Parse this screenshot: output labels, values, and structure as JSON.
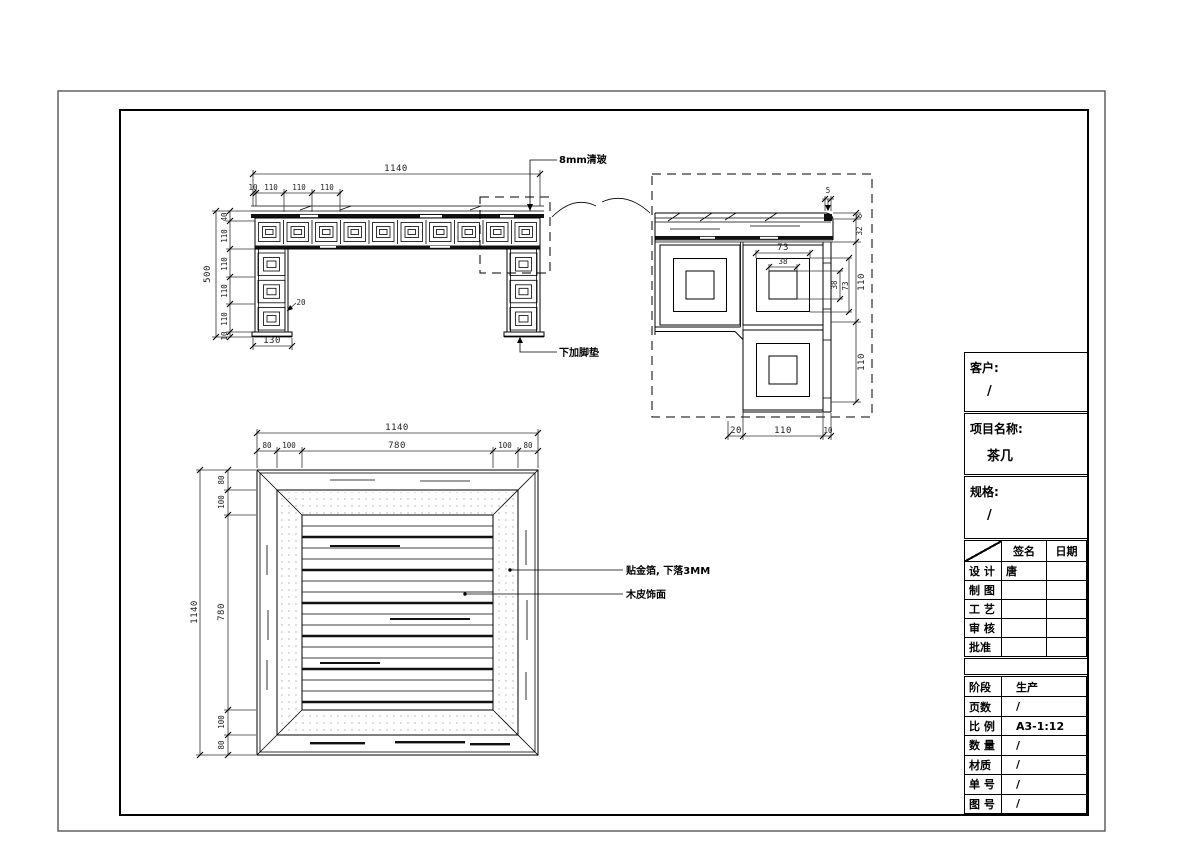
{
  "elevation": {
    "total_width": "1140",
    "top_segments": [
      "10",
      "110",
      "110",
      "110"
    ],
    "total_height": "500",
    "left_segments": [
      "40",
      "110",
      "110",
      "110",
      "110",
      "10"
    ],
    "leg_width": "130",
    "inset_dim": "20",
    "glass_label": "8mm清玻",
    "footpad_label": "下加脚垫"
  },
  "detail": {
    "overhang": "5",
    "right_segments": [
      "8",
      "32",
      "110",
      "110"
    ],
    "square_mid_width": "73",
    "square_inner_width": "38",
    "square_inner_height": "38",
    "square_mid_height": "73",
    "bottom_segments": [
      "20",
      "110",
      "10"
    ]
  },
  "plan": {
    "total_width": "1140",
    "top_segments": [
      "80",
      "100",
      "780",
      "100",
      "80"
    ],
    "total_height": "1140",
    "left_segments": [
      "80",
      "100",
      "780",
      "100",
      "80"
    ],
    "gold_label": "贴金箔, 下落3MM",
    "veneer_label": "木皮饰面"
  },
  "title_block": {
    "customer_label": "客户:",
    "customer_value": "/",
    "project_label": "项目名称:",
    "project_value": "茶几",
    "spec_label": "规格:",
    "spec_value": "/",
    "sign_col": "签名",
    "date_col": "日期",
    "sign_rows": [
      {
        "label": "设 计",
        "sign": "唐",
        "date": ""
      },
      {
        "label": "制 图",
        "sign": "",
        "date": ""
      },
      {
        "label": "工 艺",
        "sign": "",
        "date": ""
      },
      {
        "label": "审 核",
        "sign": "",
        "date": ""
      },
      {
        "label": "批准",
        "sign": "",
        "date": ""
      }
    ],
    "info_rows": [
      {
        "label": "阶段",
        "value": "生产"
      },
      {
        "label": "页数",
        "value": "/"
      },
      {
        "label": "比 例",
        "value": "A3-1:12"
      },
      {
        "label": "数 量",
        "value": "/"
      },
      {
        "label": "材质",
        "value": "/"
      },
      {
        "label": "单 号",
        "value": "/"
      },
      {
        "label": "图 号",
        "value": "/"
      }
    ]
  }
}
